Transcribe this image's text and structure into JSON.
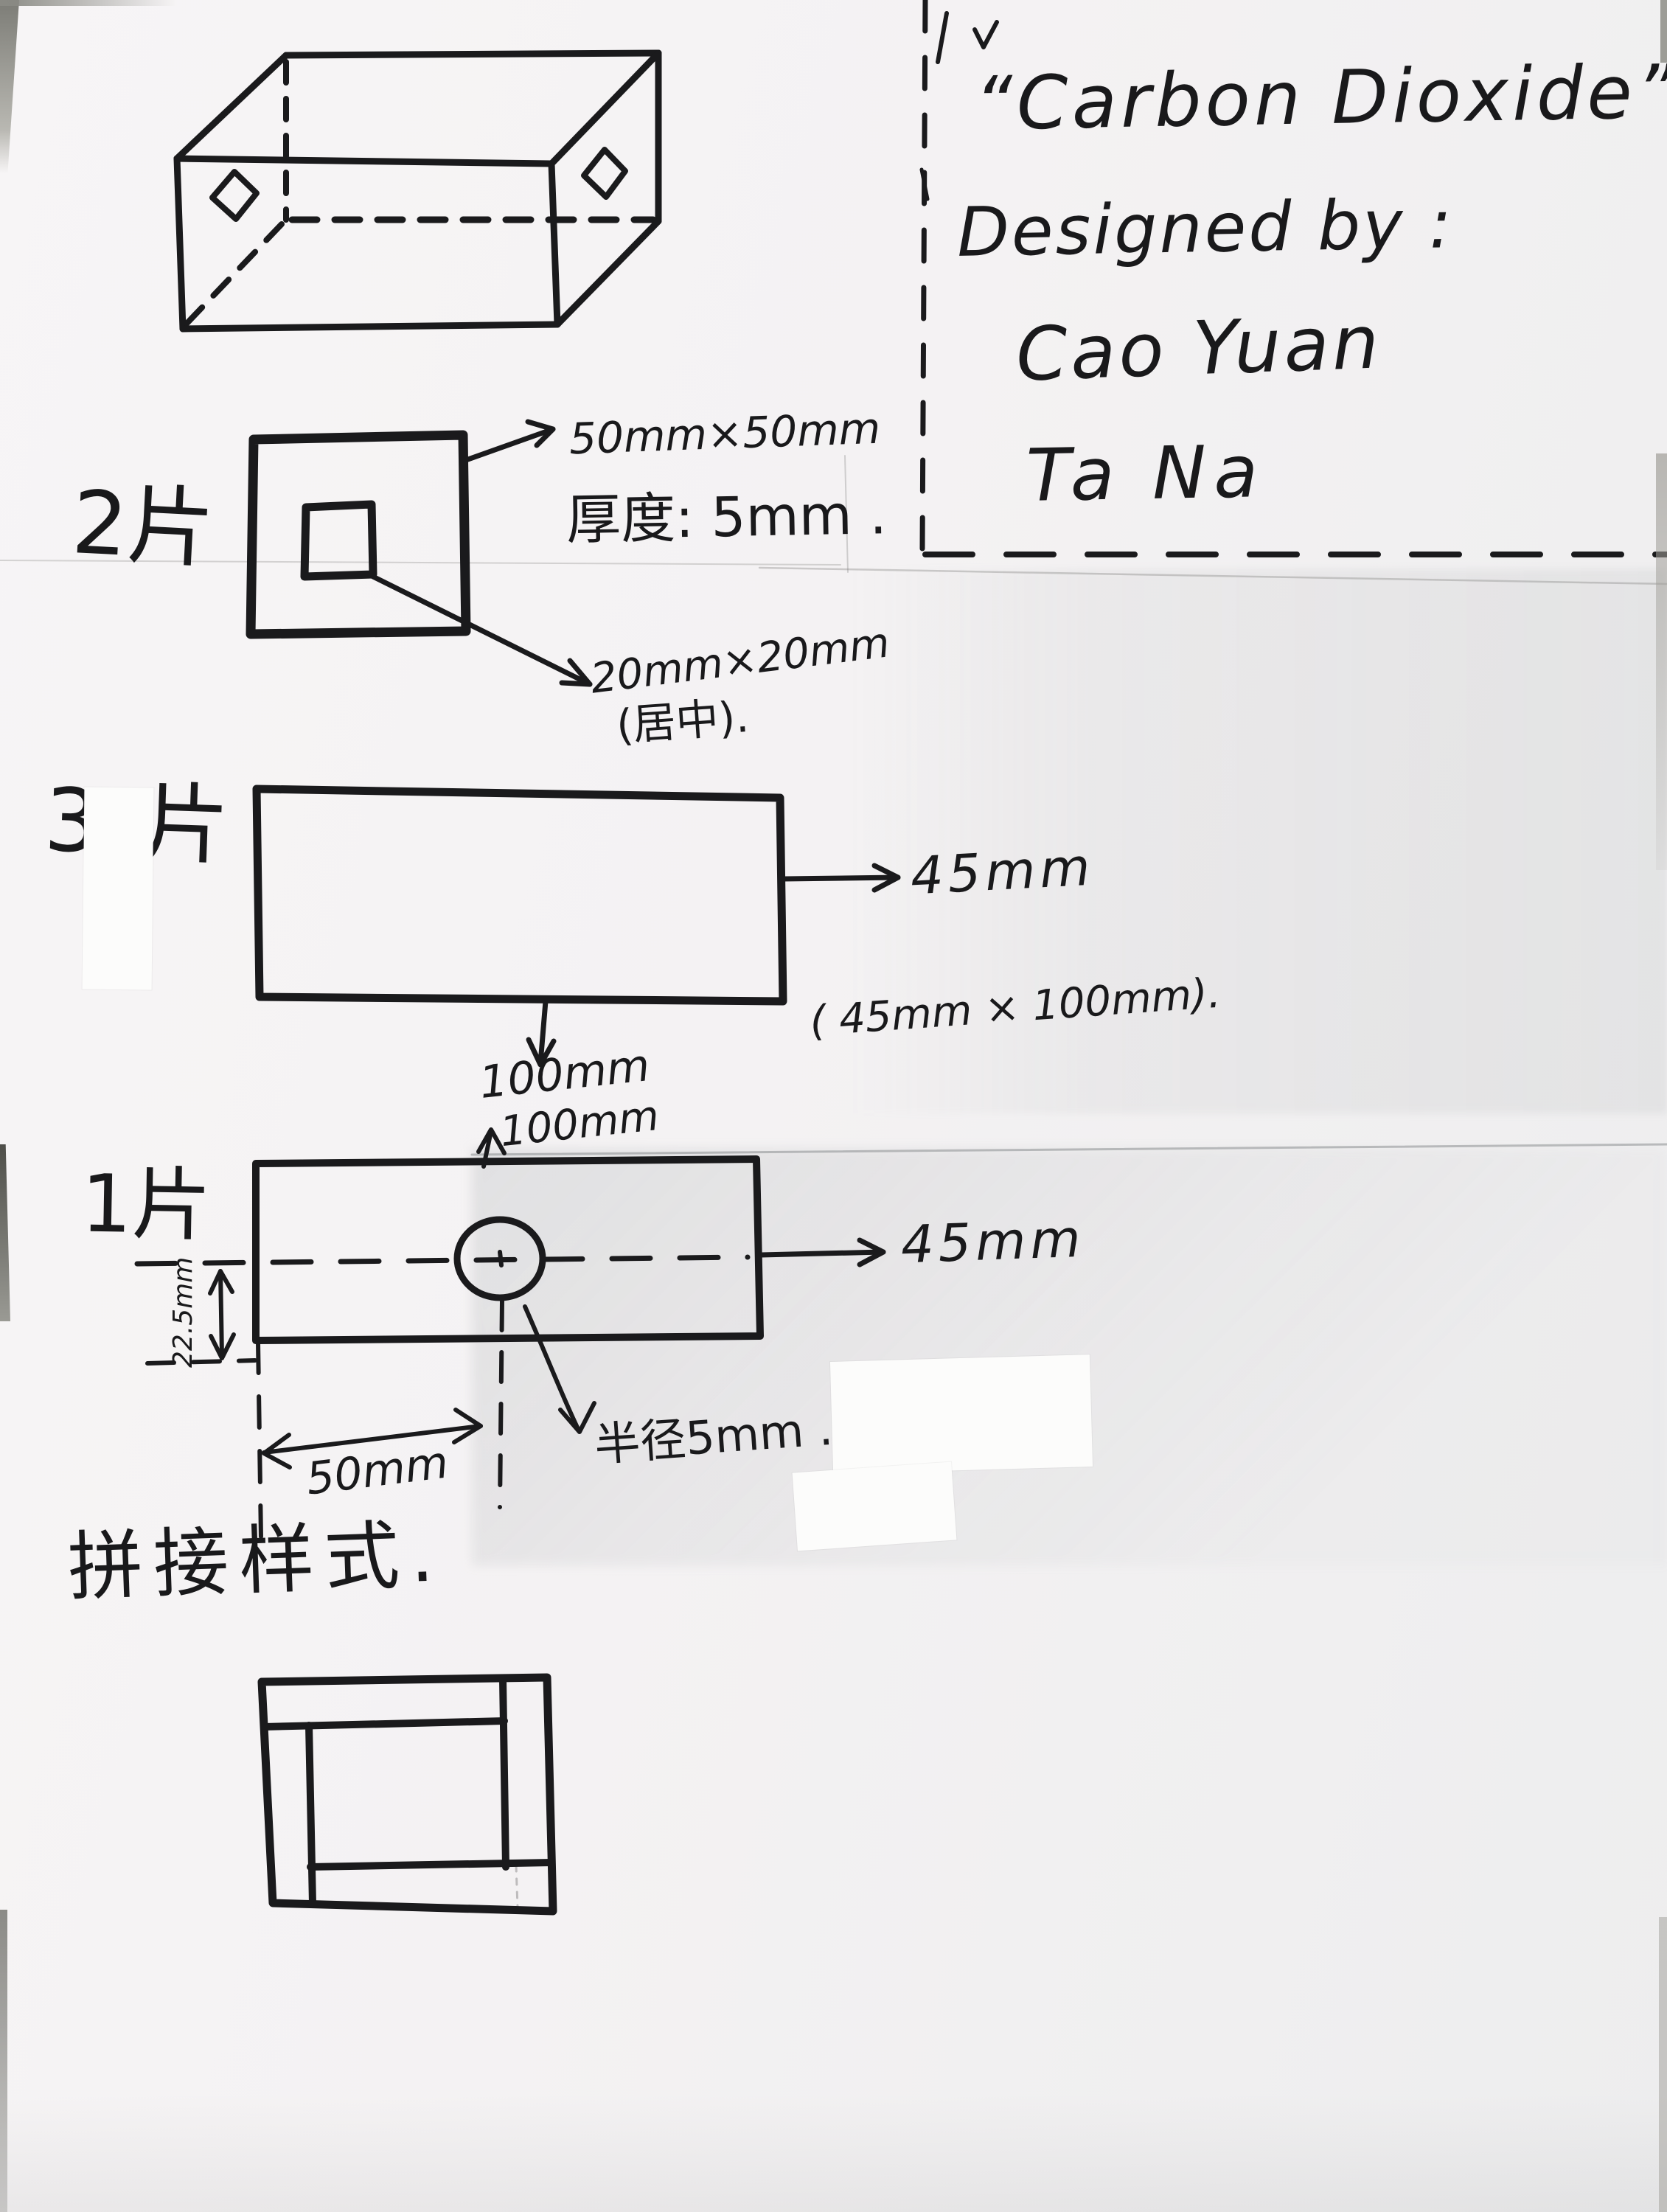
{
  "title_block": {
    "title": "“Carbon Dioxide”",
    "designed_by": "Designed by :",
    "designer_1": "Cao Yuan",
    "designer_2": "Ta Na"
  },
  "piece2": {
    "label": "2片",
    "outer_size": "50mm×50mm",
    "thickness": "厚度: 5mm .",
    "hole_size": "20mm×20mm",
    "hole_note": "(居中)."
  },
  "piece3": {
    "label": "3片",
    "width": "45mm",
    "height": "100mm",
    "note": "( 45mm × 100mm)."
  },
  "piece1": {
    "label": "1片",
    "top_dim": "100mm",
    "right_dim": "45mm",
    "offset_dim": "50mm",
    "half_height_dim": "22.5mm",
    "radius_note": "半径5mm ."
  },
  "assembly": {
    "heading": "拼接样式."
  }
}
